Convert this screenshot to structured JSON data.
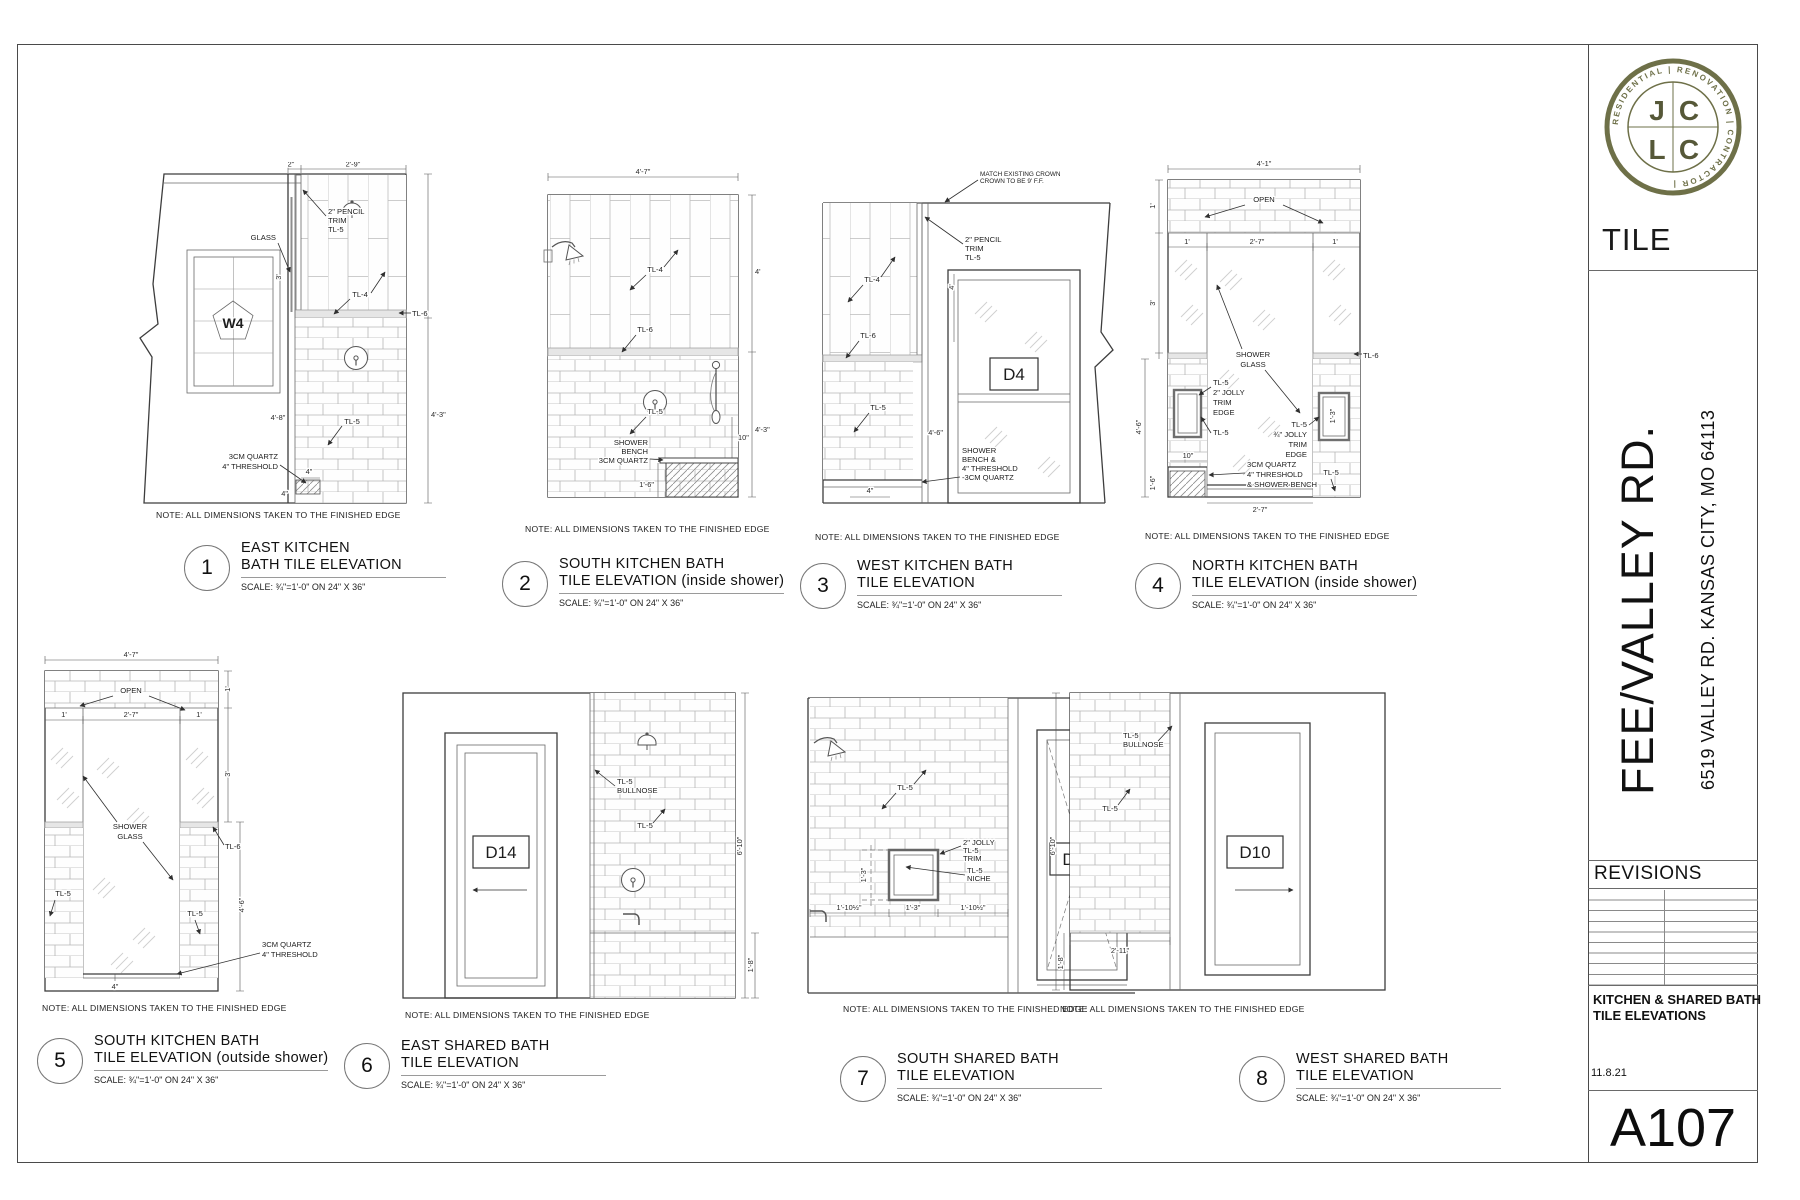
{
  "sheet": {
    "note": "NOTE: ALL DIMENSIONS TAKEN TO THE FINISHED EDGE",
    "scale": "SCALE: ¾\"=1'-0\" ON 24\" X 36\""
  },
  "titleblock": {
    "logo": {
      "letters": [
        "J",
        "C",
        "L",
        "C"
      ],
      "ring_text": "RESIDENTIAL  |  RENOVATION  |  CONTRACTOR  |"
    },
    "discipline": "TILE",
    "project": "FEE/VALLEY RD.",
    "address": "6519 VALLEY RD.  KANSAS CITY, MO 64113",
    "revisions_label": "REVISIONS",
    "sheet_title_line1": "KITCHEN & SHARED BATH",
    "sheet_title_line2": "TILE ELEVATIONS",
    "date": "11.8.21",
    "number": "A107",
    "accent_color": "#6e7048"
  },
  "drawings": [
    {
      "num": "1",
      "t1": "EAST KITCHEN",
      "t2": "BATH TILE ELEVATION",
      "labels": {
        "tag": "W4",
        "glass": "GLASS",
        "p1": "2\" PENCIL",
        "p2": "TRIM",
        "p3": "TL-5",
        "tl4": "TL-4",
        "tl6": "TL-6",
        "tl5": "TL-5",
        "q1": "3CM QUARTZ",
        "q2": "4\" THRESHOLD"
      },
      "dims": {
        "a": "2\"",
        "b": "2'-9\"",
        "c": "3'",
        "d": "4'-8\"",
        "e": "4'-3\"",
        "f": "4\"",
        "g": "4\""
      }
    },
    {
      "num": "2",
      "t1": "SOUTH KITCHEN BATH",
      "t2": "TILE ELEVATION (inside shower)",
      "labels": {
        "tl4": "TL-4",
        "tl6": "TL-6",
        "tl5": "TL-5",
        "s1": "SHOWER",
        "s2": "BENCH",
        "s3": "3CM QUARTZ"
      },
      "dims": {
        "a": "4'-7\"",
        "b": "4'",
        "c": "4'-3\"",
        "d": "10\"",
        "e": "1'-6\""
      }
    },
    {
      "num": "3",
      "t1": "WEST KITCHEN BATH",
      "t2": "TILE ELEVATION",
      "labels": {
        "tag": "D4",
        "c1": "MATCH EXISTING CROWN",
        "c2": "CROWN TO BE 9' F.F.",
        "p1": "2\" PENCIL",
        "p2": "TRIM",
        "p3": "TL-5",
        "tl4": "TL-4",
        "tl6": "TL-6",
        "tl5": "TL-5",
        "s1": "SHOWER",
        "s2": "BENCH &",
        "s3": "4\" THRESHOLD",
        "s4": "-3CM QUARTZ"
      },
      "dims": {
        "a": "4'",
        "b": "4'-6\"",
        "c": "4\""
      }
    },
    {
      "num": "4",
      "t1": "NORTH KITCHEN BATH",
      "t2": "TILE ELEVATION (inside shower)",
      "labels": {
        "open": "OPEN",
        "g1": "SHOWER",
        "g2": "GLASS",
        "tl6": "TL-6",
        "tl5a": "TL-5",
        "j1": "2\" JOLLY",
        "j2": "TRIM",
        "j3": "EDGE",
        "tl5b": "TL-5",
        "tl5c": "TL-5",
        "k1": "¾\" JOLLY",
        "k2": "TRIM",
        "k3": "EDGE",
        "q1": "3CM QUARTZ",
        "q2": "4\" THRESHOLD",
        "q3": "& SHOWER BENCH",
        "tl5d": "TL-5"
      },
      "dims": {
        "a": "4'-1\"",
        "b": "1'",
        "c": "2'-7\"",
        "d": "1'",
        "e": "1'",
        "f": "3'",
        "g": "4'-6\"",
        "h": "10\"",
        "i": "1'-6\"",
        "j": "1'-3\"",
        "k": "2'-7\""
      }
    },
    {
      "num": "5",
      "t1": "SOUTH KITCHEN BATH",
      "t2": "TILE ELEVATION (outside shower)",
      "labels": {
        "open": "OPEN",
        "g1": "SHOWER",
        "g2": "GLASS",
        "tl6": "TL-6",
        "tl5a": "TL-5",
        "tl5b": "TL-5",
        "q1": "3CM QUARTZ",
        "q2": "4\" THRESHOLD"
      },
      "dims": {
        "a": "4'-7\"",
        "b": "1'",
        "c": "2'-7\"",
        "d": "1'",
        "e": "1'",
        "f": "3'",
        "g": "4'-6\"",
        "h": "4\""
      }
    },
    {
      "num": "6",
      "t1": "EAST SHARED BATH",
      "t2": "TILE ELEVATION",
      "labels": {
        "tag": "D14",
        "b1": "TL-5",
        "b2": "BULLNOSE",
        "tl5": "TL-5"
      },
      "dims": {
        "a": "6'-10\"",
        "b": "1'-8\""
      }
    },
    {
      "num": "7",
      "t1": "SOUTH SHARED BATH",
      "t2": "TILE ELEVATION",
      "labels": {
        "tag": "D15",
        "j1": "2\" JOLLY",
        "j2": "TL-5",
        "j3": "TRIM",
        "n1": "TL-5",
        "n2": "NICHE",
        "tl5": "TL-5"
      },
      "dims": {
        "a": "1'-3\"",
        "b": "1'-10½\"",
        "c": "1'-3\"",
        "d": "1'-10½\""
      }
    },
    {
      "num": "8",
      "t1": "WEST SHARED BATH",
      "t2": "TILE ELEVATION",
      "labels": {
        "tag": "D10",
        "b1": "TL-5",
        "b2": "BULLNOSE",
        "tl5": "TL-5"
      },
      "dims": {
        "a": "6'-10\"",
        "b": "2'-11\"",
        "c": "1'-8\""
      }
    }
  ]
}
